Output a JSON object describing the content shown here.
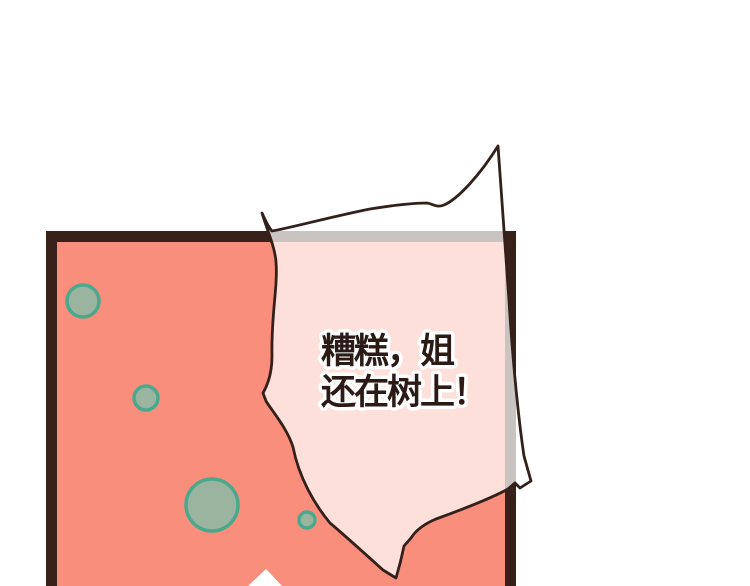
{
  "scene": {
    "type": "comic-panel",
    "speech_bubble": {
      "lines": [
        "糟糕，姐",
        "还在树上！"
      ]
    },
    "colors": {
      "page_bg": "#ffffff",
      "panel_border": "#38211b",
      "panel_fill": "#f98e7c",
      "bubble_fill": "rgba(255,255,255,0.73)",
      "bubble_outline": "#33201b",
      "circle_fill": "#9ab4a0",
      "circle_stroke": "#4aa98c",
      "text_color": "#2b1a15",
      "text_outline": "#ffffff",
      "tail_fill": "#ffffff"
    }
  }
}
